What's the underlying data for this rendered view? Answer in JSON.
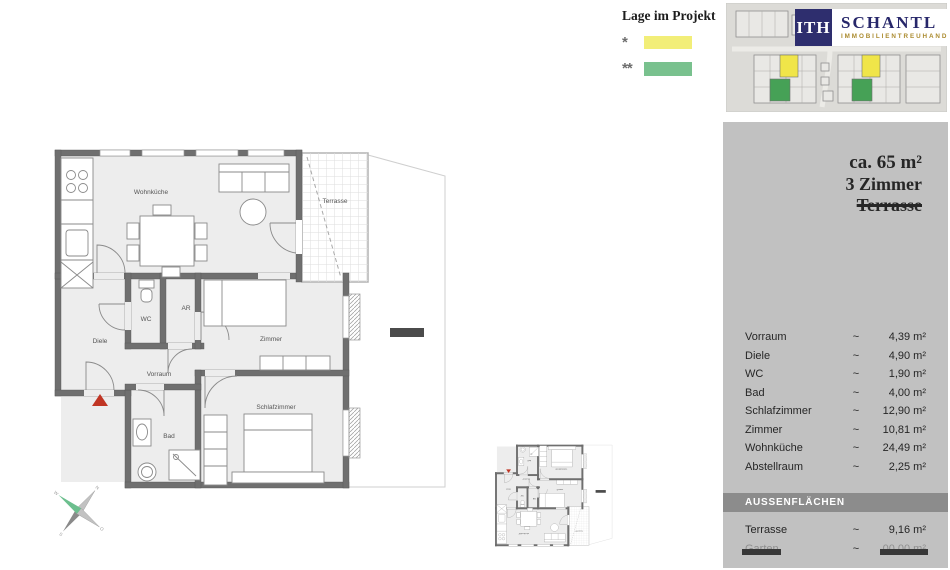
{
  "legend": {
    "title": "Lage im Projekt",
    "items": [
      {
        "symbol": "*",
        "color": "#f2ee78"
      },
      {
        "symbol": "**",
        "color": "#79c18e"
      }
    ]
  },
  "logo": {
    "monogram": "ITH",
    "name": "SCHANTL",
    "subtitle": "IMMOBILIENTREUHAND",
    "navy": "#2e2e6e",
    "gold": "#ab8b2f"
  },
  "site_plan": {
    "highlight_yellow": "#f0e549",
    "highlight_green": "#46a156"
  },
  "floor_plan": {
    "labels": {
      "wohnkueche": "Wohnküche",
      "terrasse": "Terrasse",
      "wc": "WC",
      "ar": "AR",
      "diele": "Diele",
      "zimmer": "Zimmer",
      "vorraum": "Vorraum",
      "schlafzimmer": "Schlafzimmer",
      "bad": "Bad"
    },
    "entrance_marker_color": "#c03524"
  },
  "panel": {
    "summary": {
      "line1": "ca. 65 m²",
      "line2": "3 Zimmer",
      "line3": "Terrasse",
      "line3_struck": true
    },
    "rooms": [
      {
        "label": "Vorraum",
        "approx": "~",
        "value": "4,39 m²"
      },
      {
        "label": "Diele",
        "approx": "~",
        "value": "4,90 m²"
      },
      {
        "label": "WC",
        "approx": "~",
        "value": "1,90 m²"
      },
      {
        "label": "Bad",
        "approx": "~",
        "value": "4,00 m²"
      },
      {
        "label": "Schlafzimmer",
        "approx": "~",
        "value": "12,90 m²"
      },
      {
        "label": "Zimmer",
        "approx": "~",
        "value": "10,81 m²"
      },
      {
        "label": "Wohnküche",
        "approx": "~",
        "value": "24,49 m²"
      },
      {
        "label": "Abstellraum",
        "approx": "~",
        "value": "2,25 m²"
      }
    ],
    "outdoor": {
      "header": "AUSSENFLÄCHEN",
      "rows": [
        {
          "label": "Terrasse",
          "approx": "~",
          "value": "9,16 m²",
          "redacted": false
        },
        {
          "label": "Garten",
          "approx": "~",
          "value": "00,00 m²",
          "redacted": true
        }
      ]
    }
  },
  "compass": {
    "n": "N",
    "e": "O",
    "s": "S",
    "w": "W"
  }
}
